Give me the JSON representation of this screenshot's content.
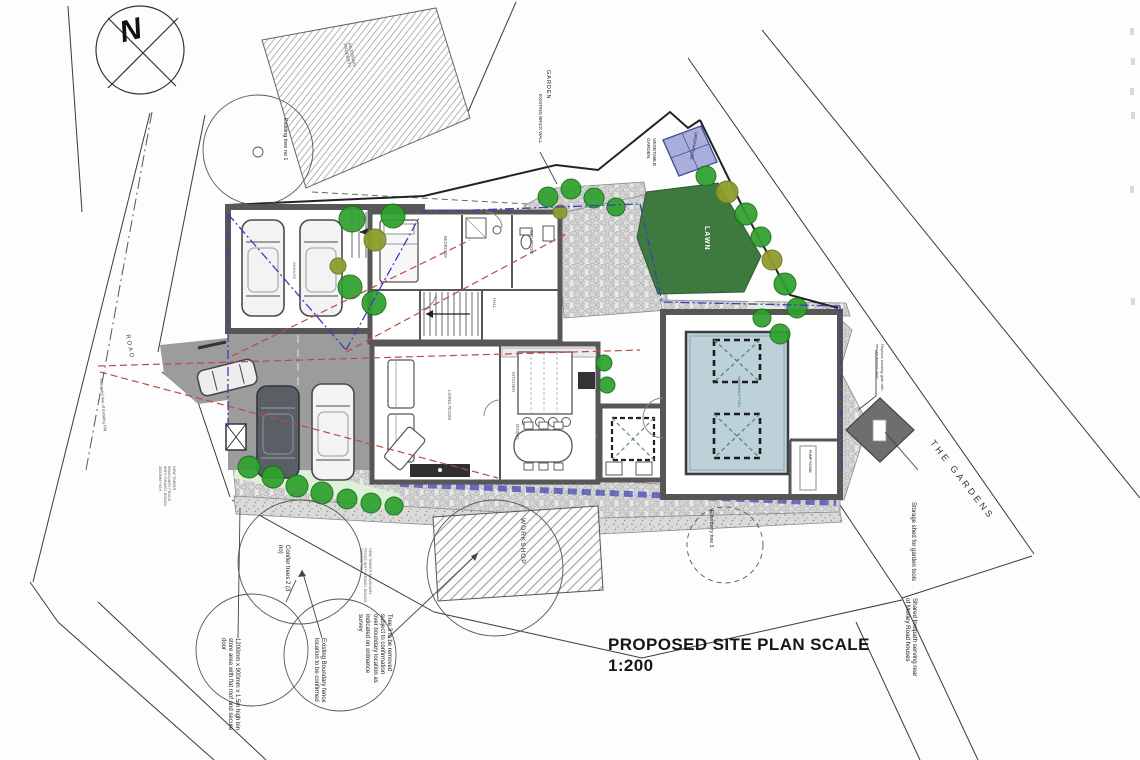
{
  "drawing": {
    "title_line1": "PROPOSED SITE PLAN SCALE",
    "title_line2": "1:200",
    "north_indicator": "N"
  },
  "labels": {
    "adjoining_property": "ADJOINING PROPERTY",
    "garden": "GARDEN",
    "existing_brick_wall": "EXISTING BRICK WALL",
    "vegetable_garden": "VEGETABLE GARDEN",
    "greenhouse": "GREENHOUSE",
    "lawn": "LAWN",
    "existing_tree_1": "Existing tree no 1",
    "road": "ROAD",
    "assumed_line": "Assumed line of Existing FW",
    "garage": "GARAGE",
    "bedroom": "BEDROOM",
    "bathroom": "BATHROOM",
    "hall": "HALL",
    "living_room": "LIVING ROOM",
    "kitchen": "KITCHEN",
    "dining": "DINING",
    "swimming_pool": "SWIMMING POOL",
    "pump_room": "PUMP ROOM",
    "the_gardens": "THE GARDENS",
    "storage_shed": "Storage shed for garden tools",
    "replace_gate": "Replace existing gate with secure access door",
    "shared_footpath": "Shared footpath serving rear of Morley Road houses",
    "workshop": "WORKSHOP",
    "elderberry_tree": "Elderberry tree 3",
    "tree3_note": "Tree 3 to be removed subject to confirmation over boundary location as indicated on ordnance survey",
    "existing_boundary_note": "Existing Boundary fence location to be confirmed",
    "conifer_trees": "Conifer trees 2 (3 no)",
    "bin_store_note": "1200mm x 900mm x 1.5m high bin store area with flat roof and secure door",
    "fence_note": "NEW TIMBER BOUNDARY FENCE WITH GRAVEL BOARD 2000MM HIGH"
  },
  "colors": {
    "lawn_green": "#3e7a40",
    "tree_green": "#2fa12f",
    "tree_olive": "#8f9d2e",
    "pool_blue": "#bcd2d8",
    "greenhouse_blue": "#a9aedd",
    "wall_grey": "#575757",
    "paving_grey": "#9c9c9c",
    "sightline_red": "#c04848",
    "splay_blue": "#3d3dbb"
  }
}
